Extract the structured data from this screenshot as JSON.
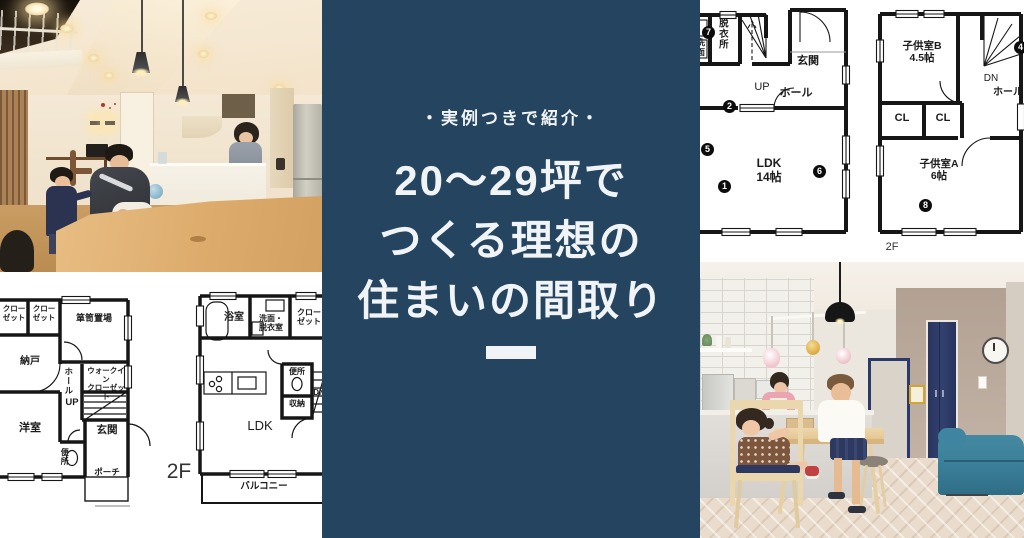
{
  "colors": {
    "panel-navy": "#25445f",
    "title-text": "#f1f4f6",
    "plan-ink": "#161616",
    "door-navy": "#2c3a67",
    "sofa-teal": "#3a7d98"
  },
  "title_panel": {
    "badge": "・実例つきで紹介・",
    "line1": "20〜29坪で",
    "line2": "つくる理想の",
    "line3": "住まいの間取り"
  },
  "plan_top_right": {
    "floor_label": "2F",
    "rooms": {
      "washroom_cut": "洗面",
      "dressing": "脱衣所",
      "entrance": "玄関",
      "up": "UP",
      "hall_1f": "ホール",
      "ldk": "LDK\n14帖",
      "kids_b": "子供室B\n4.5帖",
      "dn": "DN",
      "hall_2f": "ホール",
      "cl_left": "CL",
      "cl_right": "CL",
      "kids_a": "子供室A\n6帖"
    },
    "markers": {
      "m1": "1",
      "m2": "2",
      "m4": "4",
      "m5": "5",
      "m6": "6",
      "m7": "7",
      "m8": "8"
    }
  },
  "plan_bottom_left": {
    "floor_label": "2F",
    "f1": {
      "closet_a": "クロー\nゼット",
      "closet_b": "クロー\nゼット",
      "tansu": "箪笥置場",
      "nando": "納戸",
      "hall": "ホール",
      "wic": "ウォークイン\nクローゼット",
      "up": "UP",
      "west_room": "洋室",
      "entrance": "玄関",
      "toilet": "便所",
      "porch": "ポーチ"
    },
    "f2": {
      "bath": "浴室",
      "washroom": "洗面・\n脱衣室",
      "closet": "クロー\nゼット",
      "dn": "DN",
      "toilet": "便所",
      "storage": "収納",
      "ldk": "LDK",
      "balcony": "バルコニー"
    }
  }
}
